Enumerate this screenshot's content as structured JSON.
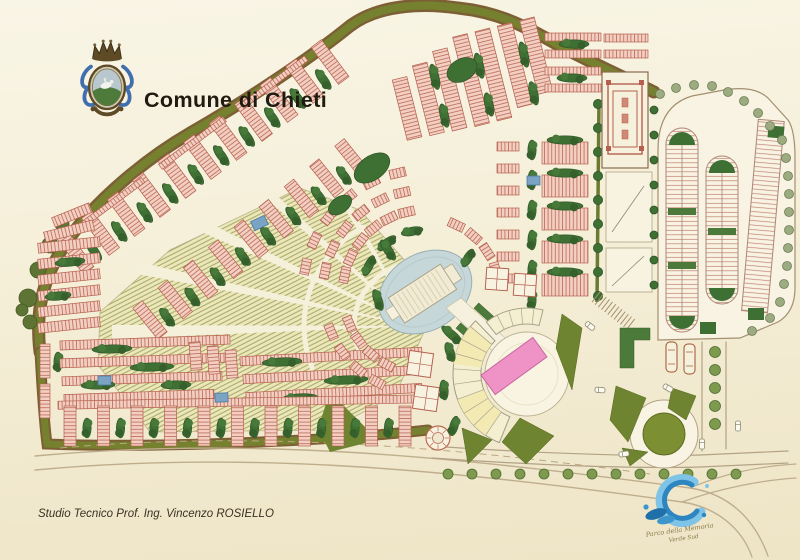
{
  "header": {
    "title": "Comune di Chieti"
  },
  "credit": {
    "text": "Studio Tecnico Prof. Ing. Vincenzo ROSIELLO"
  },
  "logo": {
    "line1": "Parco della Memoria",
    "line2": "Verde Sud"
  },
  "icons": {
    "crest": "chieti-coat-of-arms",
    "water_logo": "water-swirl-logo"
  },
  "colors": {
    "background": "#f5efd8",
    "boundary_olive": "#75812e",
    "boundary_brown": "#7d5f35",
    "block_pink": "#f2cfc2",
    "block_hatch": "#bb6a55",
    "hedge_green": "#3e6f33",
    "field_olive": "#9ba052",
    "plaza_cream": "#f9f4e2",
    "building_pink": "#ef93c6",
    "pool_blue": "#7aa3c4",
    "logo_blue": "#3c96cc",
    "text_dark": "#201b10"
  }
}
